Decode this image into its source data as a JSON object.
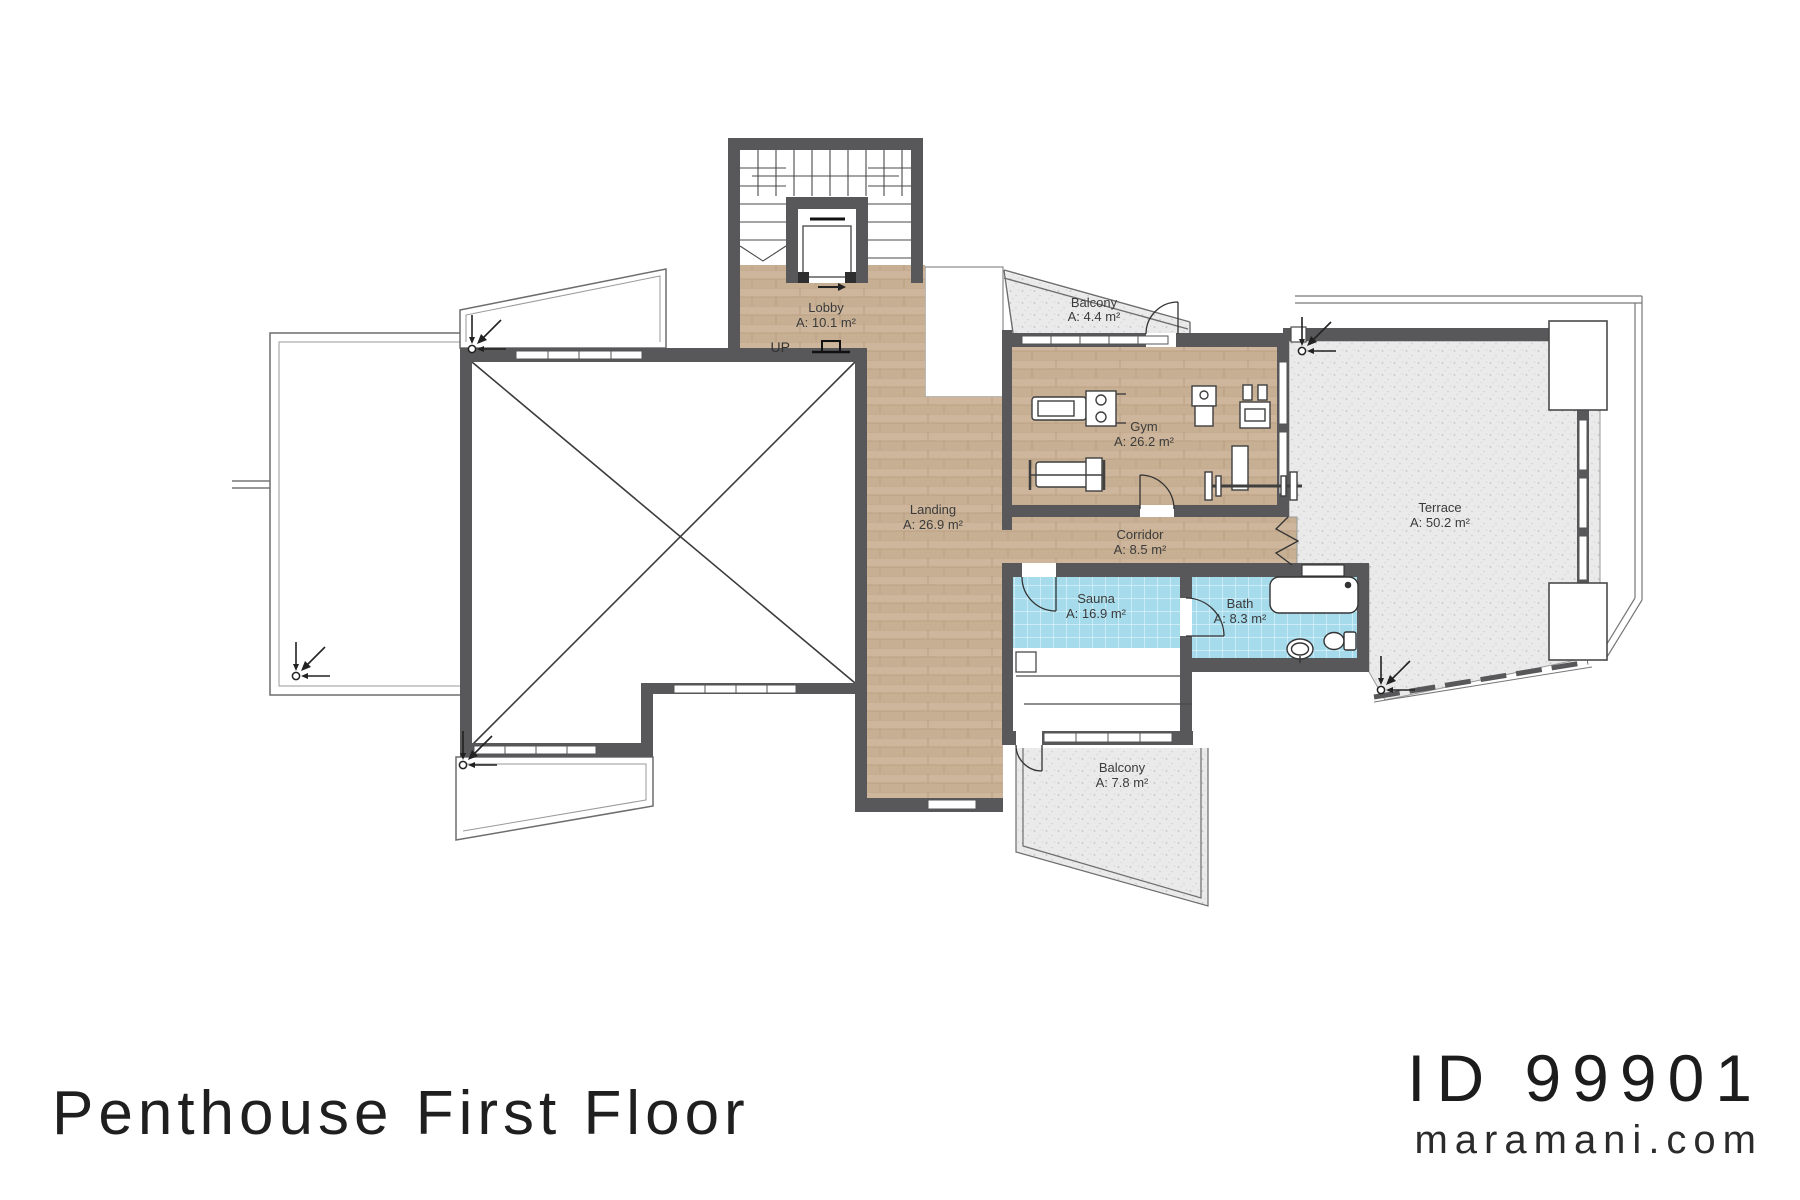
{
  "plan": {
    "title": "Penthouse First Floor",
    "id": "ID 99901",
    "website": "maramani.com",
    "up_label": "UP"
  },
  "rooms": {
    "lobby": {
      "name": "Lobby",
      "area": "A: 10.1 m²"
    },
    "landing": {
      "name": "Landing",
      "area": "A: 26.9 m²"
    },
    "gym": {
      "name": "Gym",
      "area": "A: 26.2 m²"
    },
    "corridor": {
      "name": "Corridor",
      "area": "A: 8.5 m²"
    },
    "sauna": {
      "name": "Sauna",
      "area": "A: 16.9 m²"
    },
    "bath": {
      "name": "Bath",
      "area": "A: 8.3 m²"
    },
    "terrace": {
      "name": "Terrace",
      "area": "A: 50.2 m²"
    },
    "balcony_top": {
      "name": "Balcony",
      "area": "A: 4.4 m²"
    },
    "balcony_bottom": {
      "name": "Balcony",
      "area": "A: 7.8 m²"
    }
  },
  "colors": {
    "wall": "#58585a",
    "wood": "#cbb499",
    "tile": "#a6dbec",
    "stipple": "#eaeaea",
    "outline": "#6d6d6d"
  }
}
